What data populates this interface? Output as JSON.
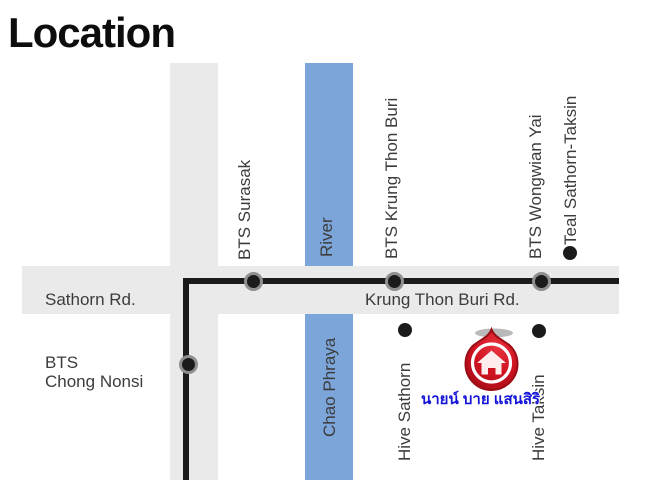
{
  "title": "Location",
  "colors": {
    "river_blue": "#7CA5DA",
    "road_gray": "#EAEAEA",
    "line_black": "#1B1B1B",
    "station_ring_gray": "#8F8F8F",
    "pin_red": "#CF1220",
    "pin_dark_red": "#9A0D15",
    "project_text_blue": "#1414D6",
    "label_gray": "#3C3C3C"
  },
  "map": {
    "roads": {
      "sathorn": "Sathorn Rd.",
      "krung_thon_buri": "Krung Thon Buri Rd."
    },
    "river": {
      "top_label": "River",
      "bottom_label": "Chao Phraya"
    },
    "bts": {
      "surasak": "BTS Surasak",
      "krung_thon_buri": "BTS Krung Thon Buri",
      "wongwian_yai": "BTS Wongwian Yai",
      "chong_nonsi_line1": "BTS",
      "chong_nonsi_line2": "Chong Nonsi"
    },
    "landmarks": {
      "teal": "Teal Sathorn-Taksin",
      "hive_sathorn": "Hive Sathorn",
      "hive_taksin": "Hive Taksin",
      "project_name_thai": "นายน์ บาย แสนสิริ"
    }
  }
}
